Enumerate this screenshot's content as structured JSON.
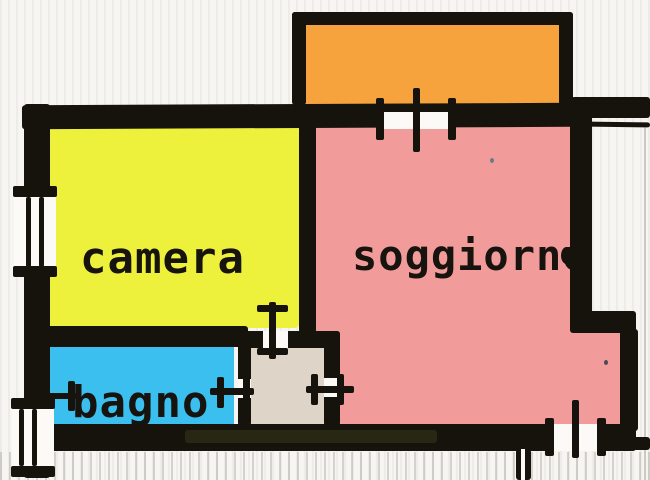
{
  "floorplan": {
    "rooms": {
      "camera": {
        "label": "camera"
      },
      "soggiorno": {
        "label": "soggiorno"
      },
      "bagno": {
        "label": "bagno"
      }
    },
    "unlabeled_areas": [
      "balcony",
      "hallway"
    ],
    "colors": {
      "wall": "#16130c",
      "background": "#f7f5f1",
      "camera": "#eef13b",
      "soggiorno": "#f19c9b",
      "bagno": "#3bbfee",
      "balcony": "#f6a33d",
      "hallway": "#ded5c8",
      "label": "#17130e",
      "scan_tint": "#3c401c"
    }
  }
}
